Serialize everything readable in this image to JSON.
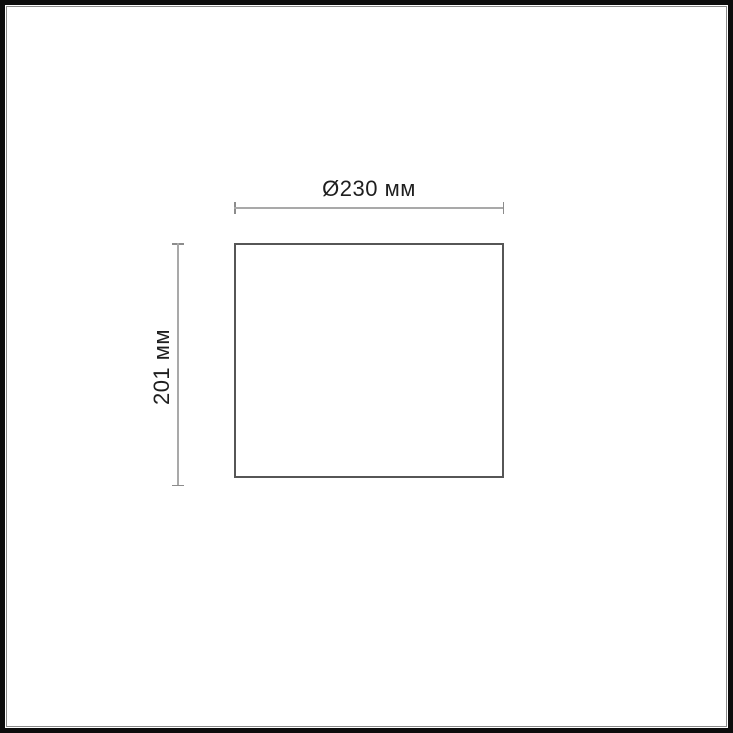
{
  "diagram": {
    "type": "technical-dimension-drawing",
    "shape": "rectangle-outline",
    "width_dimension": {
      "label": "Ø230 мм",
      "value": 230,
      "unit": "мм",
      "diameter": true
    },
    "height_dimension": {
      "label": "201 мм",
      "value": 201,
      "unit": "мм",
      "diameter": false
    }
  },
  "colors": {
    "background": "#ffffff",
    "frame_outer": "#0c0c0c",
    "frame_inner_line": "#8a8a8a",
    "outline_stroke": "#565656",
    "dimension_line": "#a9a9a9",
    "dimension_tick": "#8c8c8c",
    "label_text": "#1e1e1e"
  }
}
